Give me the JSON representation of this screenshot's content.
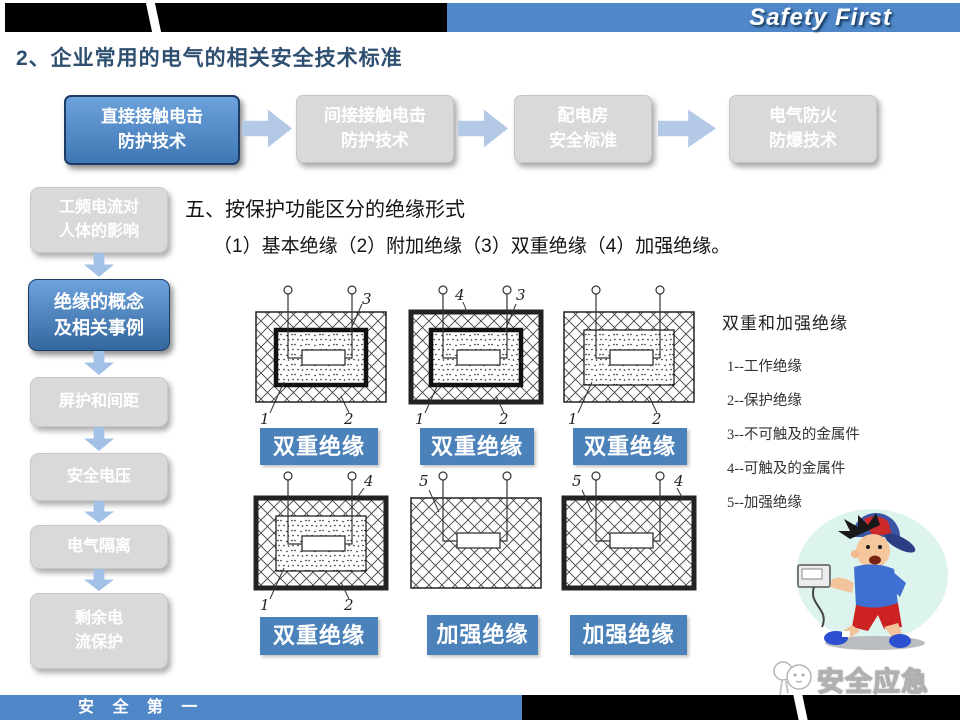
{
  "header": {
    "brand": "Safety First",
    "title": "2、企业常用的电气的相关安全技术标准"
  },
  "flow": {
    "items": [
      {
        "line1": "直接接触电击",
        "line2": "防护技术",
        "state": "active"
      },
      {
        "line1": "间接接触电击",
        "line2": "防护技术",
        "state": "idle"
      },
      {
        "line1": "配电房",
        "line2": "安全标准",
        "state": "idle"
      },
      {
        "line1": "电气防火",
        "line2": "防爆技术",
        "state": "idle"
      }
    ]
  },
  "sidebar": {
    "items": [
      {
        "line1": "工频电流对",
        "line2": "人体的影响",
        "state": "idle"
      },
      {
        "line1": "绝缘的概念",
        "line2": "及相关事例",
        "state": "active"
      },
      {
        "line1": "屏护和间距",
        "line2": "",
        "state": "idle"
      },
      {
        "line1": "安全电压",
        "line2": "",
        "state": "idle"
      },
      {
        "line1": "电气隔离",
        "line2": "",
        "state": "idle"
      },
      {
        "line1": "剩余电",
        "line2": "流保护",
        "state": "idle"
      }
    ]
  },
  "main": {
    "heading": "五、按保护功能区分的绝缘形式",
    "subheading": "（1）基本绝缘（2）附加绝缘（3）双重绝缘（4）加强绝缘。"
  },
  "diagrams": [
    {
      "caption": "双重绝缘",
      "labels": {
        "top_right": "3",
        "bottom_left": "1",
        "bottom_right": "2"
      }
    },
    {
      "caption": "双重绝缘",
      "labels": {
        "top_left": "4",
        "top_right": "3",
        "bottom_left": "1",
        "bottom_right": "2"
      }
    },
    {
      "caption": "双重绝缘",
      "labels": {
        "bottom_left": "1",
        "bottom_right": "2"
      }
    },
    {
      "caption": "双重绝缘",
      "labels": {
        "top_right": "4",
        "bottom_left": "1",
        "bottom_right": "2"
      }
    },
    {
      "caption": "加强绝缘",
      "labels": {
        "top_left": "5"
      }
    },
    {
      "caption": "加强绝缘",
      "labels": {
        "top_left": "5",
        "top_right": "4"
      }
    }
  ],
  "legend": {
    "title": "双重和加强绝缘",
    "items": [
      "1--工作绝缘",
      "2--保护绝缘",
      "3--不可触及的金属件",
      "4--可触及的金属件",
      "5--加强绝缘"
    ]
  },
  "watermark": {
    "label": "安全应急"
  },
  "footer": {
    "slogan": "安 全 第 一"
  },
  "colors": {
    "accent_blue": "#4f87c8",
    "caption_blue": "#4b82ba",
    "arrow_blue": "#b3c9e6",
    "inactive_gray": "#d9d9d9",
    "title_navy": "#2e4f70"
  }
}
